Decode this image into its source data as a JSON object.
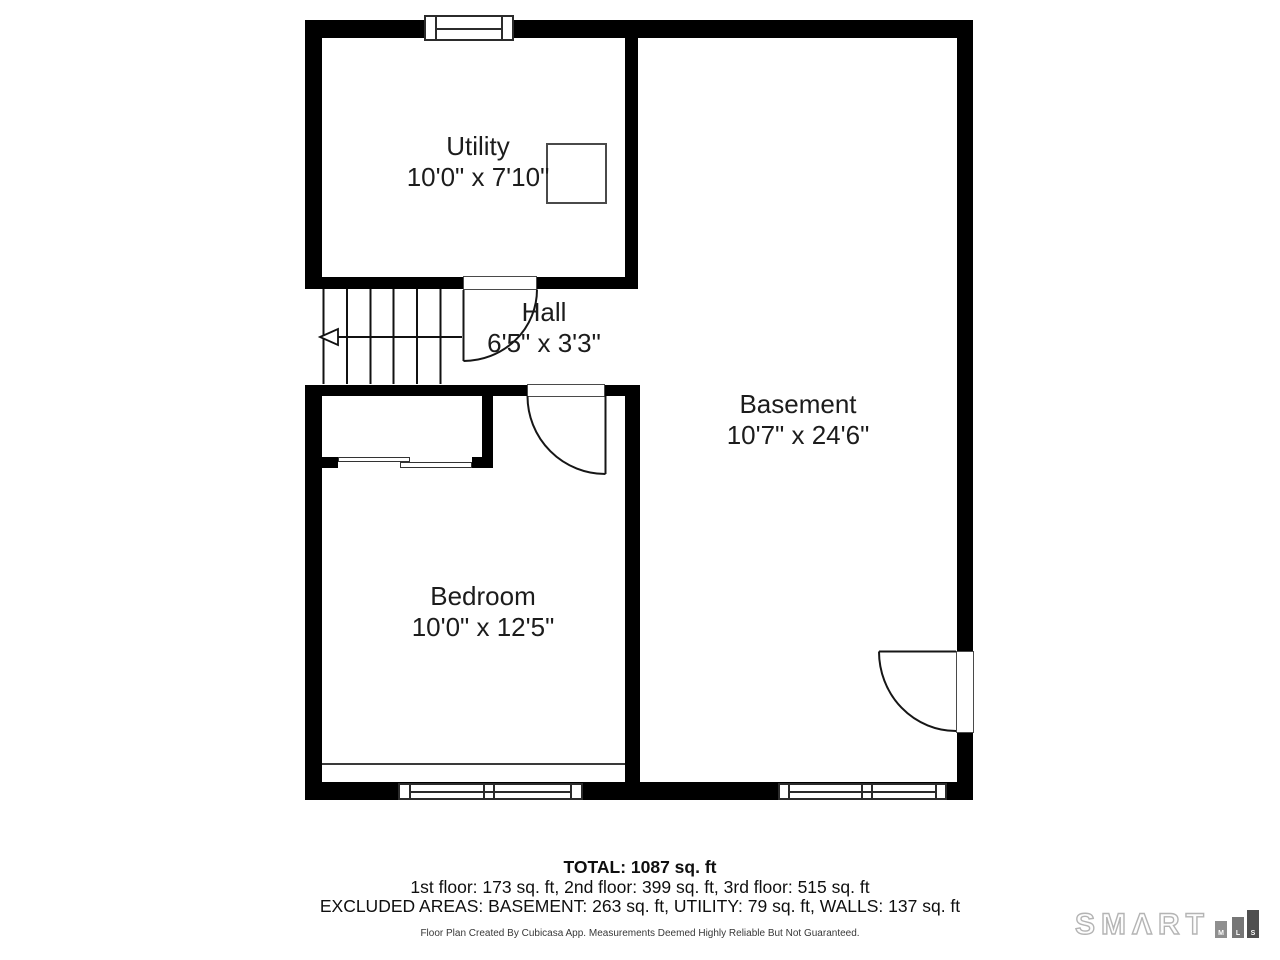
{
  "rooms": {
    "utility": {
      "name": "Utility",
      "dims": "10'0\" x 7'10\""
    },
    "hall": {
      "name": "Hall",
      "dims": "6'5\" x 3'3\""
    },
    "basement": {
      "name": "Basement",
      "dims": "10'7\" x 24'6\""
    },
    "bedroom": {
      "name": "Bedroom",
      "dims": "10'0\" x 12'5\""
    }
  },
  "summary": {
    "total": "TOTAL: 1087 sq. ft",
    "floors": "1st floor: 173 sq. ft, 2nd floor: 399 sq. ft, 3rd floor: 515 sq. ft",
    "excluded": "EXCLUDED AREAS: BASEMENT: 263 sq. ft, UTILITY: 79 sq. ft, WALLS: 137 sq. ft"
  },
  "footer": "Floor Plan Created By Cubicasa App. Measurements Deemed Highly Reliable But Not Guaranteed.",
  "logo": {
    "brand": "SMΛRT",
    "bars": [
      "M",
      "L",
      "S"
    ]
  },
  "colors": {
    "wall": "#000000",
    "line": "#1a1a1a",
    "text": "#1c1c1c",
    "logo_outline": "#b4b4b4",
    "bar_m": "#8f8f8f",
    "bar_l": "#767676",
    "bar_s": "#4f4f4f"
  }
}
